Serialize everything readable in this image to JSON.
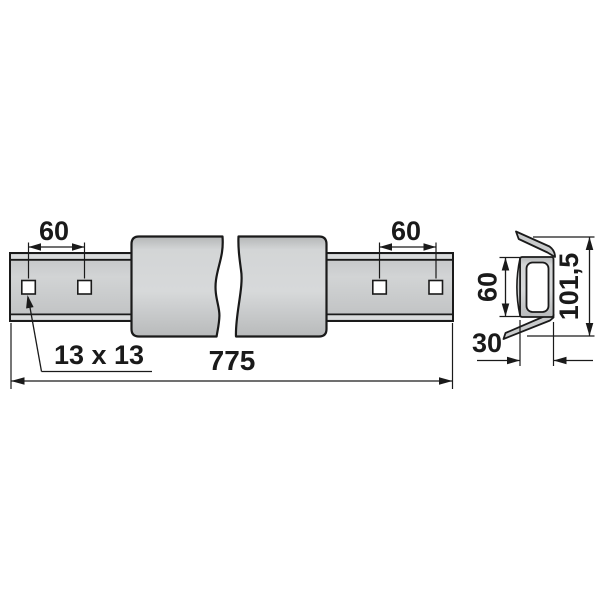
{
  "drawing": {
    "kind": "technical dimension drawing",
    "subject": "long rail bar with square holes, broken view, with end cross-section profile",
    "views": {
      "side_view": "rail with 4 square holes and middle sleeve block interrupted by break lines",
      "section_view": "channel profile with flared top and bottom lips"
    },
    "labels": {
      "spacing_left": "60",
      "spacing_right": "60",
      "hole": "13 x 13",
      "length": "775",
      "sec_inner": "60",
      "sec_total": "101,5",
      "sec_width": "30"
    },
    "colors": {
      "background": "#ffffff",
      "outline": "#1a1a1a",
      "metal_light": "#d7d9da",
      "metal_mid": "#c9cbcc",
      "metal_dark": "#b4b6b7",
      "hole_fill": "#ffffff"
    }
  }
}
